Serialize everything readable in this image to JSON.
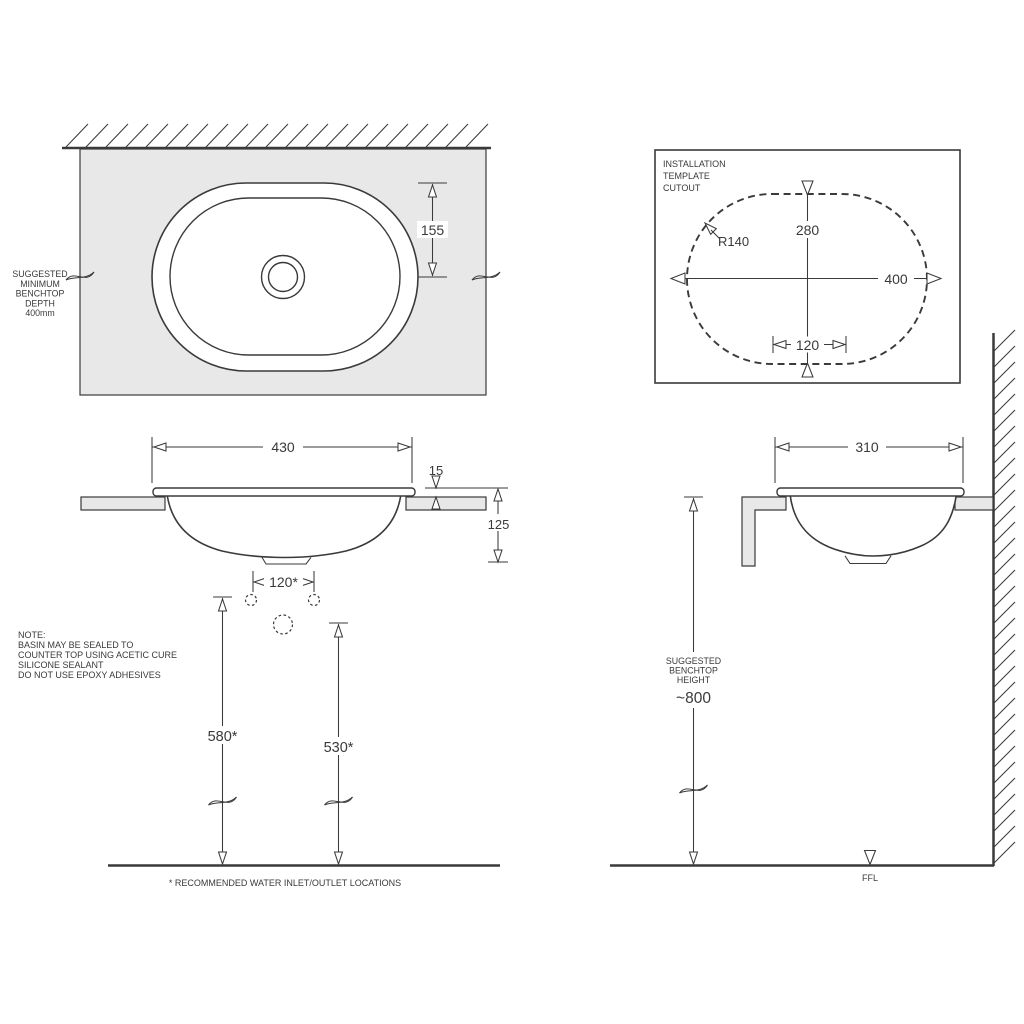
{
  "colors": {
    "line_color": "#3a3a3a",
    "benchtop_fill": "#e8e8e8",
    "background": "#ffffff"
  },
  "plan_view": {
    "depth_note_lines": [
      "SUGGESTED",
      "MINIMUM",
      "BENCHTOP",
      "DEPTH",
      "400mm"
    ],
    "dim_rim_to_center": "155"
  },
  "template": {
    "title_lines": [
      "INSTALLATION",
      "TEMPLATE",
      "CUTOUT"
    ],
    "dim_cutout_height": "280",
    "dim_cutout_width": "400",
    "dim_flat_section": "120",
    "corner_radius": "R140"
  },
  "front_elevation": {
    "dim_overall_width": "430",
    "dim_rim_height": "15",
    "dim_basin_depth": "125",
    "dim_inlet_spacing": "120*",
    "dim_inlet_height": "580*",
    "dim_outlet_height": "530*",
    "note_lines": [
      "NOTE:",
      "BASIN MAY BE SEALED TO",
      "COUNTER TOP USING ACETIC CURE",
      "SILICONE SEALANT",
      "DO NOT USE EPOXY ADHESIVES"
    ],
    "footnote": "* RECOMMENDED WATER INLET/OUTLET LOCATIONS"
  },
  "side_elevation": {
    "dim_overall_depth": "310",
    "height_note_lines": [
      "SUGGESTED",
      "BENCHTOP",
      "HEIGHT"
    ],
    "dim_benchtop_height": "~800",
    "floor_label": "FFL"
  }
}
